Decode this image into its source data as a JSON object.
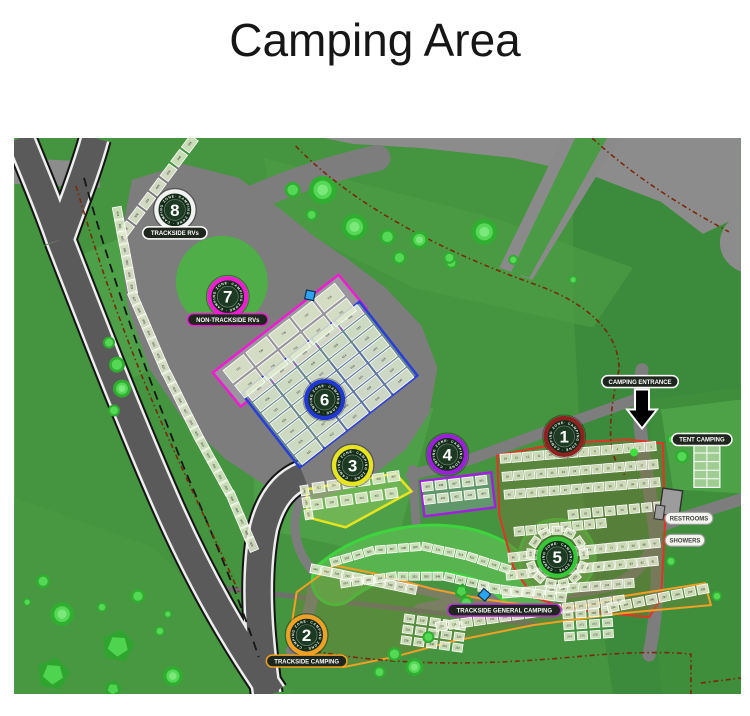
{
  "page": {
    "title": "Camping Area"
  },
  "map": {
    "labels": [
      {
        "id": "trackside_rvs",
        "text": "TRACKSIDE RVs",
        "style": "dark",
        "border": "#ffffff"
      },
      {
        "id": "non_trackside_rvs",
        "text": "NON-TRACKSIDE RVs",
        "style": "dark",
        "border": "#ee1dd2"
      },
      {
        "id": "camping_entrance",
        "text": "CAMPING ENTRANCE",
        "style": "dark",
        "border": "#ffffff"
      },
      {
        "id": "tent_camping",
        "text": "TENT CAMPING",
        "style": "dark",
        "border": "#ffffff"
      },
      {
        "id": "restrooms",
        "text": "RESTROOMS",
        "style": "light"
      },
      {
        "id": "showers",
        "text": "SHOWERS",
        "style": "light"
      },
      {
        "id": "trackside_general_camping",
        "text": "TRACKSIDE GENERAL CAMPING",
        "style": "dark",
        "border": "#b92fd8"
      },
      {
        "id": "trackside_camping",
        "text": "TRACKSIDE CAMPING",
        "style": "dark",
        "border": "#f0a024"
      }
    ],
    "zones": [
      {
        "number": "1",
        "ring_color": "#8e2220",
        "ring_text": "CAMPING ZONE",
        "sites_range": "1-115",
        "strips": [
          {
            "geo": "z1r1",
            "start": 14,
            "step": -1,
            "count": 14
          },
          {
            "geo": "z1r2",
            "start": 29,
            "step": -1,
            "count": 14
          },
          {
            "geo": "z1r3",
            "start": 45,
            "step": -1,
            "count": 14
          },
          {
            "geo": "z1r4",
            "start": 54,
            "step": -1,
            "count": 8
          },
          {
            "geo": "z1r5",
            "start": 64,
            "step": -1,
            "count": 8
          },
          {
            "geo": "z1r6",
            "start": 80,
            "step": -1,
            "count": 14
          },
          {
            "geo": "z1r7",
            "start": 94,
            "step": -1,
            "count": 14
          },
          {
            "geo": "z1r8",
            "start": 113,
            "step": -1,
            "count": 12
          }
        ]
      },
      {
        "number": "2",
        "ring_color": "#f0a024",
        "ring_text": "CAMPING ZONE",
        "sites_range": "201-300",
        "strips": [
          {
            "geo": "z2u1",
            "start": 245,
            "step": -1,
            "count": 10
          },
          {
            "geo": "z2u2",
            "start": 283,
            "step": 1,
            "count": 8
          },
          {
            "geo": "z2blk",
            "start": 266,
            "step": 1,
            "count": 12
          },
          {
            "geo": "z2low",
            "start": 218,
            "step": 1,
            "count": 15
          },
          {
            "geo": "z2bot",
            "start": 215,
            "step": -1,
            "count": 15
          },
          {
            "geo": "z2right",
            "start": 293,
            "step": 1,
            "count": 8
          },
          {
            "geo": "z2c",
            "start": 248,
            "step": 1,
            "count": 3
          }
        ]
      },
      {
        "number": "3",
        "ring_color": "#e8e51f",
        "ring_text": "CAMPING ZONE",
        "sites_range": "301-312",
        "strips": [
          {
            "geo": "z3r1",
            "start": 312,
            "step": -1,
            "count": 6
          },
          {
            "geo": "z3r2",
            "start": 306,
            "step": -1,
            "count": 6
          }
        ]
      },
      {
        "number": "4",
        "ring_color": "#9b1fd8",
        "ring_text": "CAMPING ZONE",
        "sites_range": "400-409",
        "strips": [
          {
            "geo": "z4r1",
            "start": 409,
            "step": -1,
            "count": 5
          },
          {
            "geo": "z4r2",
            "start": 400,
            "step": 1,
            "count": 5
          }
        ]
      },
      {
        "number": "5",
        "ring_color": "#37c837",
        "ring_text": "CAMPING ZONE",
        "sites_range": "501-558",
        "strips": [
          {
            "geo": "z5top",
            "start": 502,
            "step": 1,
            "count": 16
          },
          {
            "geo": "z5ring",
            "start": 518,
            "step": 1,
            "count": 13
          },
          {
            "geo": "z5bot",
            "start": 557,
            "step": -1,
            "count": 13
          }
        ]
      },
      {
        "number": "6",
        "ring_color": "#2038d0",
        "ring_text": "CAMPING ZONE",
        "sites_range": "601-640",
        "strips": [
          {
            "geo": "z6grid",
            "start": 601,
            "step": 1,
            "count": 35
          }
        ]
      },
      {
        "number": "7",
        "ring_color": "#ee1dd2",
        "ring_text": "CAMPING ZONE",
        "sites_range": "701-710",
        "strips": [
          {
            "geo": "z7grid",
            "start": 710,
            "step": -1,
            "count": 10
          }
        ]
      },
      {
        "number": "8",
        "ring_color": "#f2f2f2",
        "ring_text": "CAMPING ZONE",
        "sites_range": "801-841",
        "strips": [
          {
            "geo": "z8top",
            "start": 841,
            "step": -1,
            "count": 7
          },
          {
            "geo": "z8long",
            "start": 834,
            "step": -1,
            "count": 30
          }
        ]
      }
    ],
    "colors": {
      "field": "#459440",
      "field_dark": "#3c8a3b",
      "paved": "#7d7d7d",
      "track": "#5a5a5a",
      "site_box": "#dfe9cb",
      "tree": "#3fcf3f",
      "fence_line": "#7a2808",
      "zone1_outline": "#e23325",
      "zone2_outline": "#f0a024",
      "zone3_outline": "#e6e41f",
      "zone4_outline": "#a21fe0",
      "zone5_outline": "#3ed43e",
      "zone6_outline": "#2a3fd6",
      "zone7_outline": "#ee1dd2"
    }
  }
}
